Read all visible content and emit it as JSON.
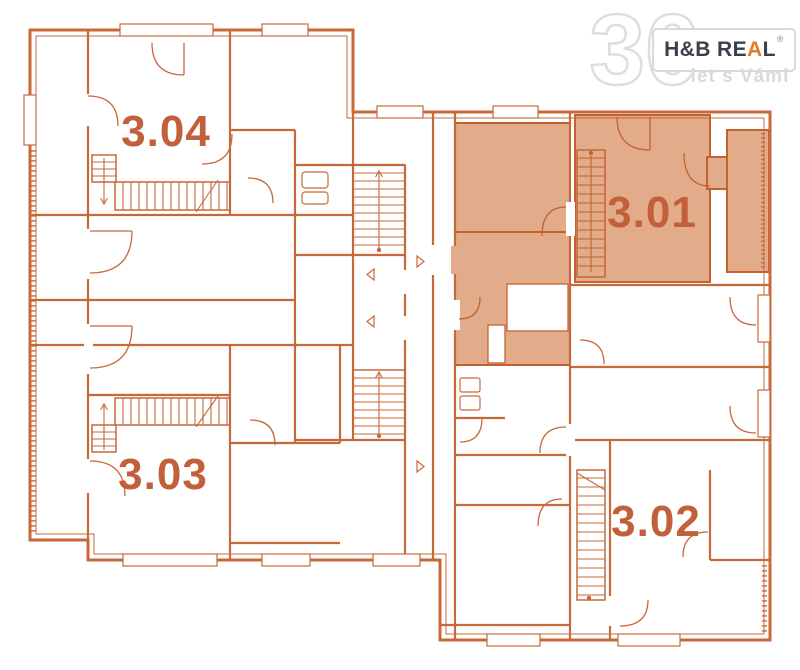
{
  "floor_plan": {
    "units": [
      {
        "label": "3.04",
        "highlighted": false
      },
      {
        "label": "3.03",
        "highlighted": false
      },
      {
        "label": "3.01",
        "highlighted": true
      },
      {
        "label": "3.02",
        "highlighted": false
      }
    ],
    "colors": {
      "wall_line": "#c7693a",
      "highlight_fill": "#e2ab8a",
      "highlight_stroke": "#c4622f",
      "unit_label": "#c2603c",
      "background": "#ffffff"
    }
  },
  "logo": {
    "number": "30",
    "brand_prefix": "H&B RE",
    "brand_accent": "A",
    "brand_suffix": "L",
    "registered": "®",
    "tagline": "let s Vámi",
    "accent_color": "#e87a22",
    "text_color": "#3a4049",
    "muted_color": "#dadada"
  }
}
